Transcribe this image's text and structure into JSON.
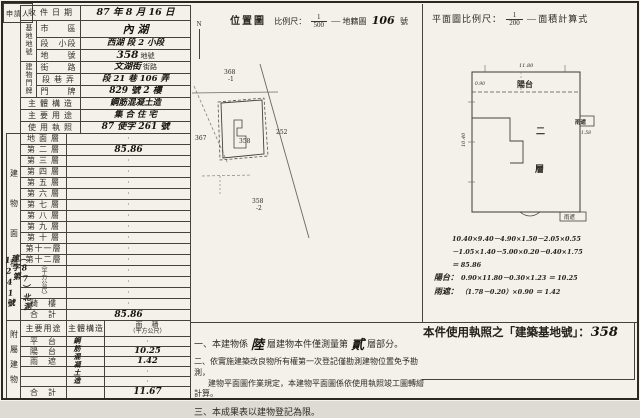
{
  "left": {
    "applicant": "申請人",
    "received_label": "收 件 日 期",
    "received_value": "87 年 8 月 16 日",
    "site_group": "基地地號",
    "city_label": "市　　區",
    "city_value": "內 湖",
    "section_label": "段　小段",
    "section_value": "西湖 段 2 小段",
    "lot_label": "地　　號",
    "lot_value": "358",
    "lot_suffix": "地號",
    "addr_group": "建物門牌",
    "street_label": "街　　路",
    "street_value": "文湖街",
    "street_suffix": "街路",
    "lane_label": "段 巷 弄",
    "lane_value": "段 21 巷 106 弄",
    "door_label": "門　　牌",
    "door_value": "829 號 2 樓",
    "structure_label": "主 體 構 造",
    "structure_value": "鋼筋混凝土造",
    "usage_label": "主 要 用 途",
    "usage_value": "集 合 住 宅",
    "license_label": "使 用 執 照",
    "license_value": "87 使字 261 號",
    "floor_vertical_label": "建物面積",
    "floor_unit": "（平方公尺）",
    "floor_rows": [
      {
        "label": "地 面 層",
        "value": "·"
      },
      {
        "label": "第 二 層",
        "value": "85.86"
      },
      {
        "label": "第 三 層",
        "value": "·"
      },
      {
        "label": "第 四 層",
        "value": "·"
      },
      {
        "label": "第 五 層",
        "value": "·"
      },
      {
        "label": "第 六 層",
        "value": "·"
      },
      {
        "label": "第 七 層",
        "value": "·"
      },
      {
        "label": "第 八 層",
        "value": "·"
      },
      {
        "label": "第 九 層",
        "value": "·"
      },
      {
        "label": "第 十 層",
        "value": "·"
      },
      {
        "label": "第十一層",
        "value": "·"
      },
      {
        "label": "第十二層",
        "value": "·"
      },
      {
        "label": "",
        "value": "·"
      },
      {
        "label": "",
        "value": "·"
      },
      {
        "label": "",
        "value": "·"
      },
      {
        "label": "騎　樓",
        "value": "·"
      },
      {
        "label": "合　計",
        "value": "85.86"
      }
    ],
    "stamp": "（87）北測建字第1241號",
    "annex_vertical_label": "附屬建物",
    "annex_col_usage": "主要用途",
    "annex_col_structure": "主體構造",
    "annex_col_area1": "面　積",
    "annex_col_area2": "（平方公尺）",
    "annex_structure": "鋼筋混凝土造",
    "annex_rows": [
      {
        "label": "平　台",
        "value": "·"
      },
      {
        "label": "陽　台",
        "value": "10.25"
      },
      {
        "label": "雨　遮",
        "value": "1.42"
      },
      {
        "label": "",
        "value": "·"
      },
      {
        "label": "",
        "value": "·"
      },
      {
        "label": "合　計",
        "value": "11.67"
      }
    ]
  },
  "mid": {
    "map_title": "位置圖",
    "scale_label": "比例尺：",
    "scale_num": "1",
    "scale_den": "500",
    "dash": "—",
    "sheet_label": "地籍圖",
    "sheet_no": "106",
    "sheet_suffix": "號",
    "north": "N",
    "parcel_368": "368",
    "parcel_368b": "-1",
    "parcel_367": "367",
    "parcel_252": "252",
    "parcel_358": "358",
    "parcel_358_2": "358",
    "parcel_358_2b": "-2"
  },
  "notes": {
    "n1_no": "一、",
    "n1_a": "本建物係",
    "n1_hand1": "陸",
    "n1_b": "層建物本件僅測量第",
    "n1_hand2": "貳",
    "n1_c": "層部分。",
    "n2_no": "二、",
    "n2_l1": "依實施建築改良物所有權第一次登記僅勘測建物位置免予勘測，",
    "n2_l2": "建物平面圖作業規定，本建物平面圖係依使用執照竣工圖轉繪計算。",
    "n3_no": "三、",
    "n3": "本成果表以建物登記為限。"
  },
  "right": {
    "plan_scale_label": "平面圖比例尺：",
    "scale_num": "1",
    "scale_den": "200",
    "dash": "—",
    "calc_title": "面積計算式",
    "balcony": "陽台",
    "canopy": "雨遮",
    "canopy_bottom": "雨遮",
    "floor_char1": "二",
    "floor_char2": "層",
    "dim_top": "11.80",
    "dim_left": "10.40",
    "dim_balcony": "0.90",
    "dim_canopy": "1.58",
    "calc_lines": [
      {
        "label": "",
        "expr": "10.40×9.40－4.90×1.50－2.05×0.55"
      },
      {
        "label": "",
        "expr": "－1.05×1.40－5.00×0.20－0.40×1.75"
      },
      {
        "label": "",
        "expr": "＝ 85.86"
      },
      {
        "label": "陽台：",
        "expr": "0.90×11.80－0.30×1.23 ＝ 10.25"
      },
      {
        "label": "雨遮：",
        "expr": "（1.78－0.20）×0.90 ＝ 1.42"
      }
    ],
    "license_prefix": "本件使用執照之「建築基地號」：",
    "license_no": "358"
  }
}
